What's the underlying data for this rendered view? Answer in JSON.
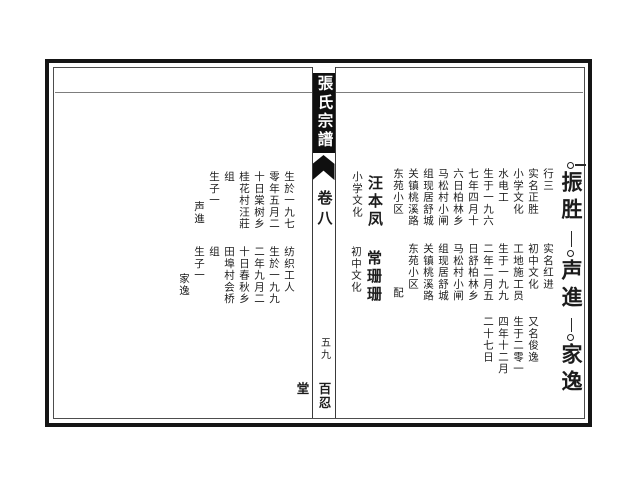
{
  "spine": {
    "book_title": "張氏宗譜",
    "volume_label": "卷八",
    "page_number": "五九",
    "hall_name": "百忍堂"
  },
  "right_page": {
    "persons": [
      {
        "chain_name": "振胜",
        "bio_columns": [
          "行三",
          "实名正胜",
          "小学文化",
          "水电工",
          "生于一九六",
          "七年四月十",
          "六日柏林乡",
          "马松村小闸",
          "组现居舒城",
          "关镇桃溪路",
          "东苑小区"
        ],
        "spouse": {
          "marker": "",
          "name": "汪本凤",
          "note": "小学文化"
        }
      },
      {
        "chain_name": "声進",
        "bio_columns": [
          "实名红进",
          "初中文化",
          "工地施工员",
          "生于一九九",
          "二年二月五",
          "日舒柏林乡",
          "马松村小闸",
          "组现居舒城",
          "关镇桃溪路",
          "东苑小区"
        ],
        "spouse": {
          "marker": "配",
          "name": "常珊珊",
          "note": "初中文化"
        }
      },
      {
        "chain_name": "家逸",
        "bio_columns": [
          "又名俊逸",
          "生于二零一",
          "四年十二月",
          "二十七日"
        ]
      }
    ]
  },
  "left_page": {
    "spouse_bios": [
      {
        "bio_columns": [
          "生於一九七",
          "零年五月二",
          "十日棠树乡",
          "桂花村汪莊",
          "组"
        ],
        "children_label": "生子一",
        "child_name": "声進"
      },
      {
        "bio_columns": [
          "纺织工人",
          "生於一九九",
          "二年九月二",
          "十日春秋乡",
          "田埠村会桥",
          "组"
        ],
        "children_label": "生子一",
        "child_name": "家逸"
      }
    ]
  },
  "colors": {
    "ink": "#1c1c1c",
    "paper": "#ffffff",
    "title_block_bg": "#0f0f0f",
    "title_text": "#ffffff"
  }
}
